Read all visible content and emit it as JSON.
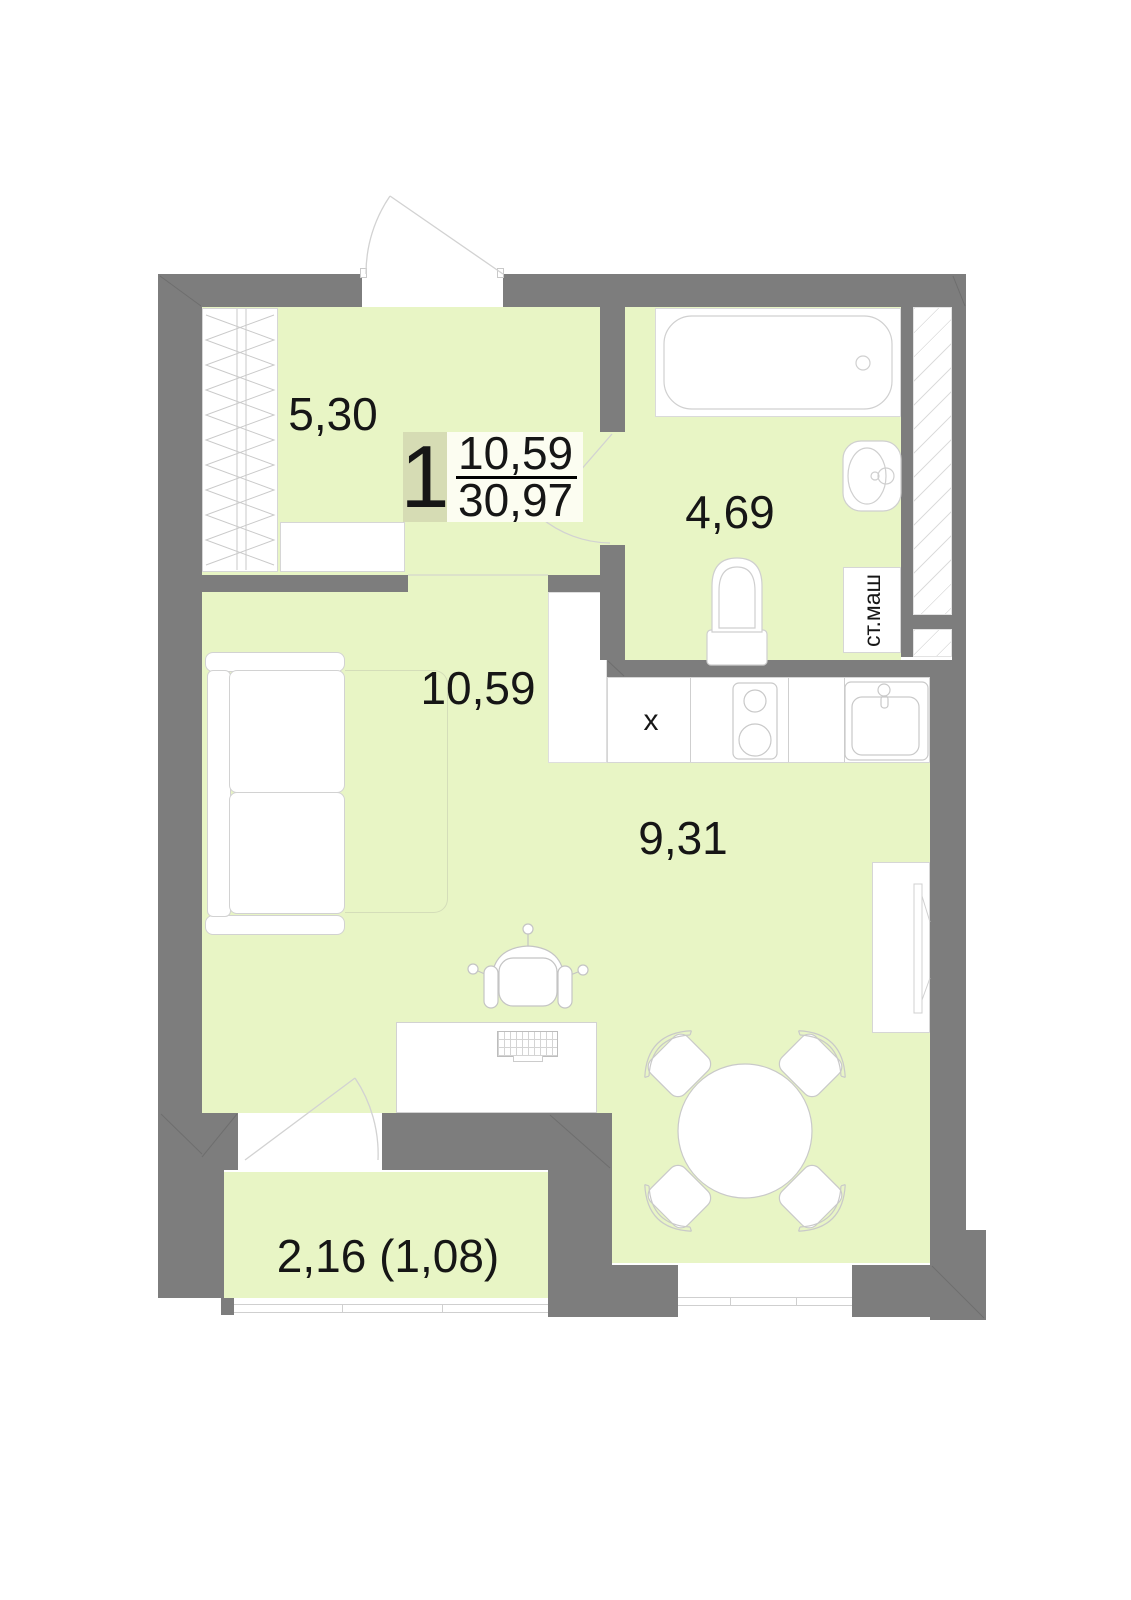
{
  "unit_card": {
    "rooms_count": "1",
    "living_area": "10,59",
    "total_area": "30,97"
  },
  "rooms": [
    {
      "name": "hallway",
      "area": "5,30"
    },
    {
      "name": "bathroom",
      "area": "4,69"
    },
    {
      "name": "living_room",
      "area": "10,59"
    },
    {
      "name": "kitchen",
      "area": "9,31"
    },
    {
      "name": "balcony",
      "area": "2,16 (1,08)"
    }
  ],
  "labels": {
    "washing_machine": "ст.маш",
    "counter_mark": "x"
  },
  "colors": {
    "floor": "#e8f5c5",
    "wall": "#7d7d7d",
    "badge_number_bg": "#d6dcb4",
    "badge_fraction_bg": "#fcfdf1",
    "furniture_outline": "#c9c9c9"
  }
}
